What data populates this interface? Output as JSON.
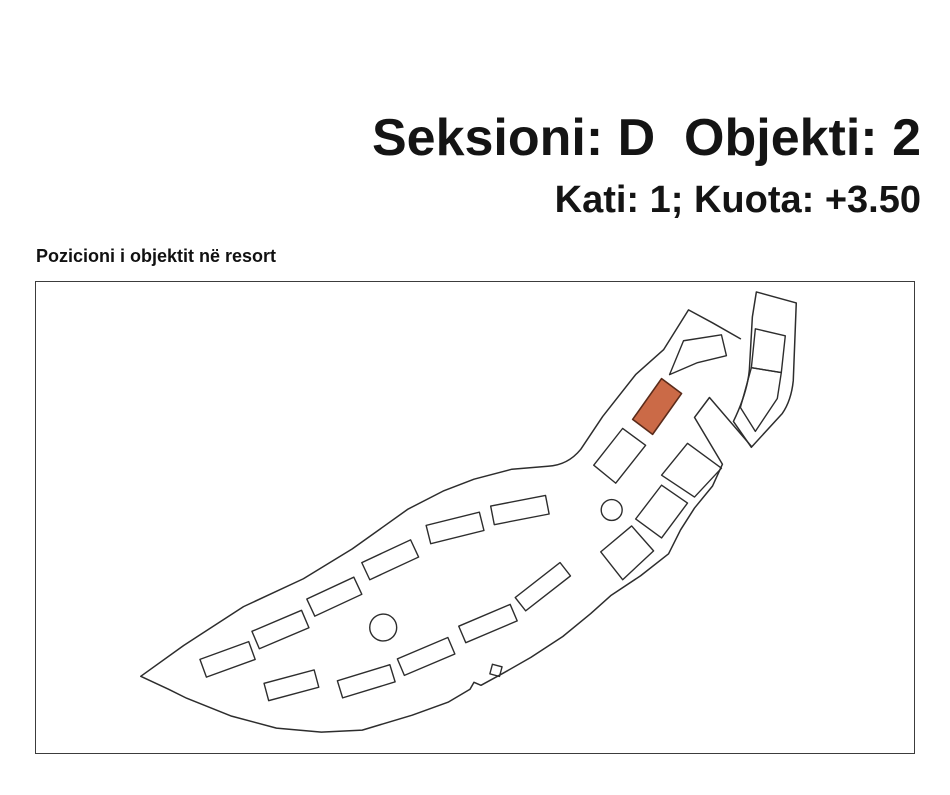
{
  "header": {
    "title": "Seksioni: D  Objekti: 2",
    "subtitle": "Kati: 1; Kuota: +3.50"
  },
  "map": {
    "label": "Pozicioni i objektit në resort",
    "highlight_color": "#cb6a47",
    "highlight_stroke": "#5a2b1a",
    "outline_color": "#2d2d2d",
    "frame_color": "#3c3c3c",
    "viewbox": "35 281 880 473",
    "shapes": [
      {
        "name": "resort-boundary-path",
        "type": "path",
        "sw": 1.5,
        "d": "M741,338 L713,322 L689,309 L664,349 L636,374 L603,416 L581,449 Q568,465 548,466 L512,469 L474,479 L443,491 L408,509 L352,549 L303,579 L243,607 L183,646 L140,677 L168,690 L186,699 L231,717 L276,729 L321,733 L362,731 L412,716 L448,703 L470,690 L474,683 L481,686 L503,674 L531,658 L563,637 L591,614 L611,596 L641,576 L669,554 L681,530 L695,508 L713,486 L723,464 L695,417 L710,397 L752,446"
      },
      {
        "name": "annex-outline",
        "type": "path",
        "sw": 1.5,
        "d": "M757,291 L797,302 L794,380 Q792,400 783,413 L752,447 L734,421 Q748,392 750,369 L753,316 Z"
      },
      {
        "name": "annex-building-upper",
        "type": "polygon",
        "points": "756,328 786,335 782,372 752,367"
      },
      {
        "name": "annex-building-lower",
        "type": "polygon",
        "points": "752,367 782,372 778,398 756,431 741,407"
      },
      {
        "name": "building-chevron",
        "type": "polygon",
        "points": "670,374 684,340 722,334 727,355 698,362"
      },
      {
        "name": "selected-object-marker",
        "type": "polygon",
        "fill": "highlight",
        "stroke": "#5a2b1a",
        "sw": 1.6,
        "points": "662,378 682,393 653,434 633,419"
      },
      {
        "name": "building-neck",
        "type": "polygon",
        "points": "623,428 646,445 616,483 594,465"
      },
      {
        "name": "building-diamond-1",
        "type": "polygon",
        "points": "662,475 688,443 722,468 695,497"
      },
      {
        "name": "building-diamond-2",
        "type": "polygon",
        "points": "636,519 662,485 688,503 662,538"
      },
      {
        "name": "building-diamond-3",
        "type": "polygon",
        "points": "601,552 632,526 654,551 623,580"
      },
      {
        "name": "building-upper-1",
        "type": "rect",
        "cx": 227,
        "cy": 660,
        "w": 52,
        "h": 19,
        "angle": -20
      },
      {
        "name": "building-upper-2",
        "type": "rect",
        "cx": 280,
        "cy": 630,
        "w": 54,
        "h": 19,
        "angle": -23
      },
      {
        "name": "building-upper-3",
        "type": "rect",
        "cx": 334,
        "cy": 597,
        "w": 52,
        "h": 19,
        "angle": -25
      },
      {
        "name": "building-upper-4",
        "type": "rect",
        "cx": 390,
        "cy": 560,
        "w": 54,
        "h": 19,
        "angle": -25
      },
      {
        "name": "building-upper-5",
        "type": "rect",
        "cx": 455,
        "cy": 528,
        "w": 55,
        "h": 19,
        "angle": -14
      },
      {
        "name": "building-upper-6",
        "type": "rect",
        "cx": 520,
        "cy": 510,
        "w": 56,
        "h": 19,
        "angle": -11
      },
      {
        "name": "building-lower-1",
        "type": "rect",
        "cx": 291,
        "cy": 686,
        "w": 52,
        "h": 18,
        "angle": -15
      },
      {
        "name": "building-lower-2",
        "type": "rect",
        "cx": 366,
        "cy": 682,
        "w": 55,
        "h": 18,
        "angle": -17
      },
      {
        "name": "building-lower-3",
        "type": "rect",
        "cx": 426,
        "cy": 657,
        "w": 55,
        "h": 18,
        "angle": -23
      },
      {
        "name": "building-lower-4",
        "type": "rect",
        "cx": 488,
        "cy": 624,
        "w": 56,
        "h": 18,
        "angle": -23
      },
      {
        "name": "building-lower-5",
        "type": "rect",
        "cx": 543,
        "cy": 587,
        "w": 57,
        "h": 17,
        "angle": -38
      },
      {
        "name": "building-small-square",
        "type": "rect",
        "cx": 496,
        "cy": 671,
        "w": 10,
        "h": 10,
        "angle": 15
      },
      {
        "name": "pool-circle-large",
        "type": "circle",
        "cx": 383,
        "cy": 628,
        "r": 13.5
      },
      {
        "name": "pool-circle-small",
        "type": "circle",
        "cx": 612,
        "cy": 510,
        "r": 10.5
      }
    ]
  }
}
